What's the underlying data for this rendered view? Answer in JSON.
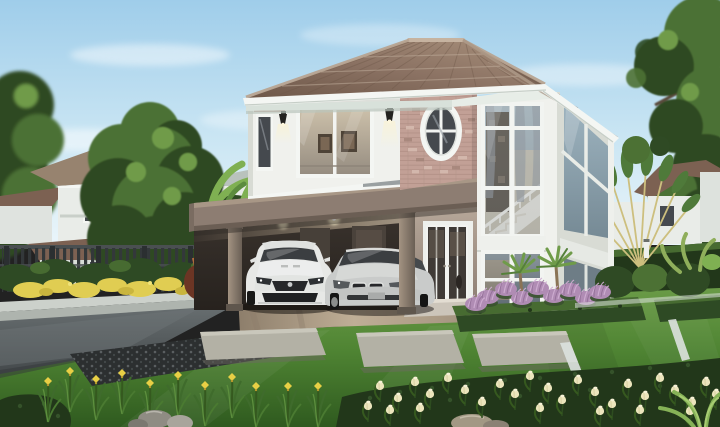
{
  "image": {
    "width": 720,
    "height": 427,
    "type": "photorealistic 3D architectural rendering",
    "time_of_day": "daytime, clear sky"
  },
  "scene": {
    "description": "Daytime 3D rendering of a modern two-storey suburban house: brown tiled hip roof, white upper walls, pink stacked-brick feature wall with an oval cross-muntin window, balcony with metal railing over a carport sheltering a white sports coupe and a silver sedan, white French entry doors, and a two-storey glazed stair bay. Landscaped garden with trimmed hedges, lawns, stepping stones, purple fountain grass, yellow flower beds, cream tulips, banana plants, a traveler's palm and neighbouring houses behind a dark fence.",
    "labels": {
      "house": "main two-storey house",
      "roof": "brown tiled hip roof",
      "brickWall": "pink brick feature wall with oval window",
      "balcony": "balcony with metal railing and sliding glass door",
      "bay": "two-storey glazed staircase bay window",
      "carport": "carport under the balcony",
      "sportsCar": "white sports coupe",
      "sedan": "silver sedan",
      "entry": "white French entry doors",
      "garden": "landscaped tropical garden",
      "neighborLeft": "neighbouring house behind trees (left)",
      "neighborRight": "neighbouring house roof (right)",
      "palm": "traveler's palm fan",
      "tulips": "cream tulip bed (foreground right)",
      "irises": "yellow iris bed (foreground left)"
    }
  },
  "palette": {
    "skyTop": "#9fcdea",
    "skyMid": "#c9e5f3",
    "skyLow": "#eaf5fa",
    "cloud": "#ffffff",
    "roofLight": "#a8907b",
    "roofMid": "#8b7263",
    "roofDark": "#6d5748",
    "roofRidge": "#c6b3a0",
    "fascia": "#f4f6f3",
    "soffit": "#e7ede7",
    "soffitShade": "#d8e1da",
    "wallWhite": "#f0f1ed",
    "wallShade": "#d8dbd4",
    "brick": "#c2a096",
    "brickLight": "#d7bcb0",
    "brickDark": "#9f8075",
    "mortar": "#ab8b81",
    "glassDark": "#45494e",
    "bayGlassTop": "#a8b6bd",
    "bayGlassBottom": "#8f9ca4",
    "angledGlassTop": "#9db3bf",
    "angledGlassBottom": "#768a95",
    "curtain": "#8d929a",
    "interiorWarm": "#cbbfa9",
    "interiorWood": "#4e4337",
    "stairWhite": "#e9e5dc",
    "railMetal": "#ced3d5",
    "parapetGray": "#9aa0a1",
    "bandTaupe": "#8d7d72",
    "bandTaupeDark": "#6b5e54",
    "column": "#998a7d",
    "columnShade": "#6a5f55",
    "carportDark": "#332d29",
    "ceilingWarm": "#cfc5b5",
    "lampGlow": "#f7edc9",
    "lampBlack": "#23221f",
    "doorWhite": "#eef0ec",
    "doorGlass": "#3f3a36",
    "porchFloor": "#ccc5ba",
    "wallTaupe": "#a4958a",
    "asphalt": "#575d5f",
    "asphaltLight": "#6e7577",
    "paver": "#a3937f",
    "paverLight": "#bfae96",
    "gravel": "#2c2f30",
    "gravelSpeck": "#5a5f61",
    "curb": "#ccd1cb",
    "curbShade": "#aeb4ae",
    "grassTop": "#6a9b47",
    "grass": "#4f8433",
    "grassDeep": "#2f5a1f",
    "hedge": "#2e4a24",
    "hedgeLight": "#476b31",
    "hedgeDark": "#22371a",
    "slab": "#b3b1a5",
    "slabShade": "#8f8d82",
    "edging": "#dde2df",
    "flowerYellow": "#e0cd52",
    "tulipCream": "#ece5bd",
    "tulipDeep": "#d8d0a2",
    "purple": "#b08cb4",
    "purpleLight": "#cfaed1",
    "treeDark": "#2f4a24",
    "treeMid": "#4c7134",
    "treeLight": "#6f9b49",
    "trunk": "#5a4a3a",
    "banana": "#7fb052",
    "bananaDark": "#5c8c3e",
    "palmGold": "#cdbf7e",
    "redShrub": "#6c3524",
    "redShrubLight": "#b06a3c",
    "fence": "#33383a",
    "fenceDark": "#2b2f31",
    "fenceRail": "#4a4f51",
    "neighborRoof": "#97836f",
    "neighborRoofDark": "#7c6152",
    "neighborWall": "#e9ece8",
    "carWhite": "#e7e8e6",
    "carWhiteShade": "#c9cbc9",
    "carSilver": "#c9cbca",
    "carSilverDark": "#9fa2a2",
    "carGlass": "#3b3e41",
    "carDetail": "#26272a",
    "stone": "#8f8c83",
    "stoneLight": "#a8a59c"
  }
}
